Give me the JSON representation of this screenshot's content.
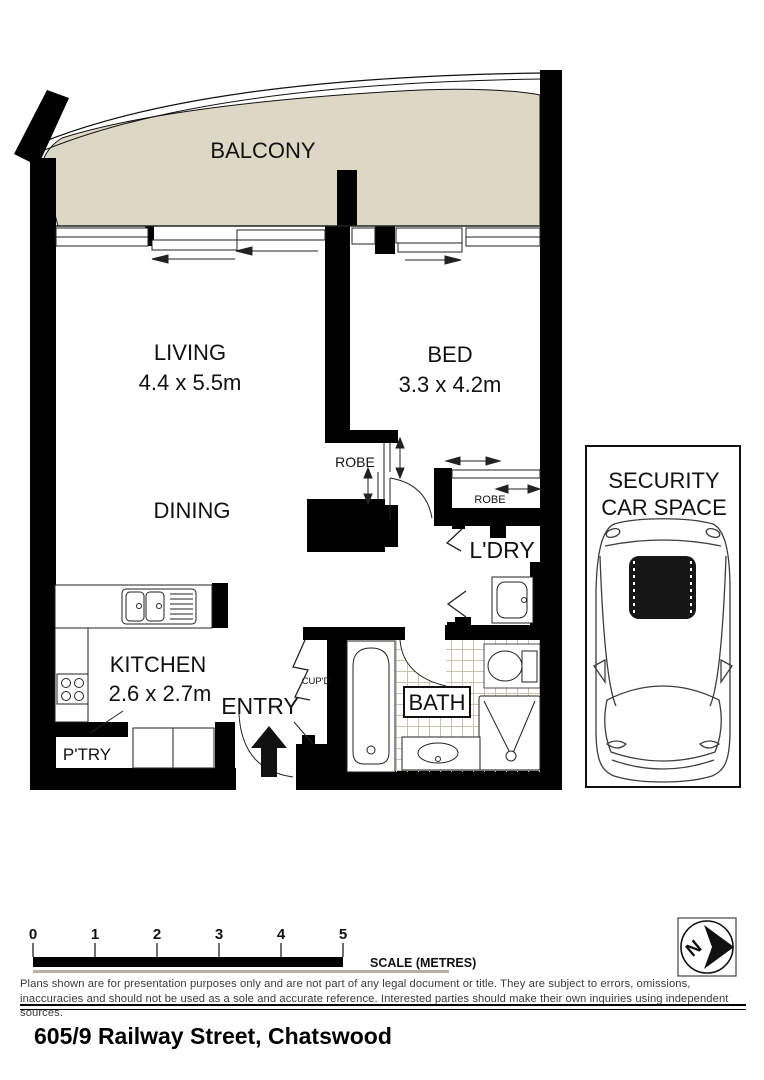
{
  "plan": {
    "balcony_label": "BALCONY",
    "living_label": "LIVING",
    "living_dims": "4.4 x 5.5m",
    "bed_label": "BED",
    "bed_dims": "3.3 x 4.2m",
    "dining_label": "DINING",
    "robe_label": "ROBE",
    "laundry_label": "L'DRY",
    "kitchen_label": "KITCHEN",
    "kitchen_dims": "2.6 x 2.7m",
    "entry_label": "ENTRY",
    "cupboard_label": "CUP'D",
    "pantry_label": "P'TRY",
    "fridge_label": "F",
    "bath_label": "BATH",
    "car_space_line1": "SECURITY",
    "car_space_line2": "CAR SPACE",
    "compass_n": "N"
  },
  "scale_bar": {
    "ticks": [
      "0",
      "1",
      "2",
      "3",
      "4",
      "5"
    ],
    "label": "SCALE (METRES)"
  },
  "footer": {
    "disclaimer": "Plans shown are for presentation purposes only and are not part of any legal document or title. They are subject to errors, omissions, inaccuracies and should not be used as a sole and accurate reference. Interested parties should make their own inquiries using independent sources.",
    "address": "605/9 Railway Street, Chatswood"
  },
  "colors": {
    "wall": "#000000",
    "balcony": "#dcd8c5",
    "tile_line": "#c8c3ae",
    "rail_gray": "#b5b2a4"
  }
}
